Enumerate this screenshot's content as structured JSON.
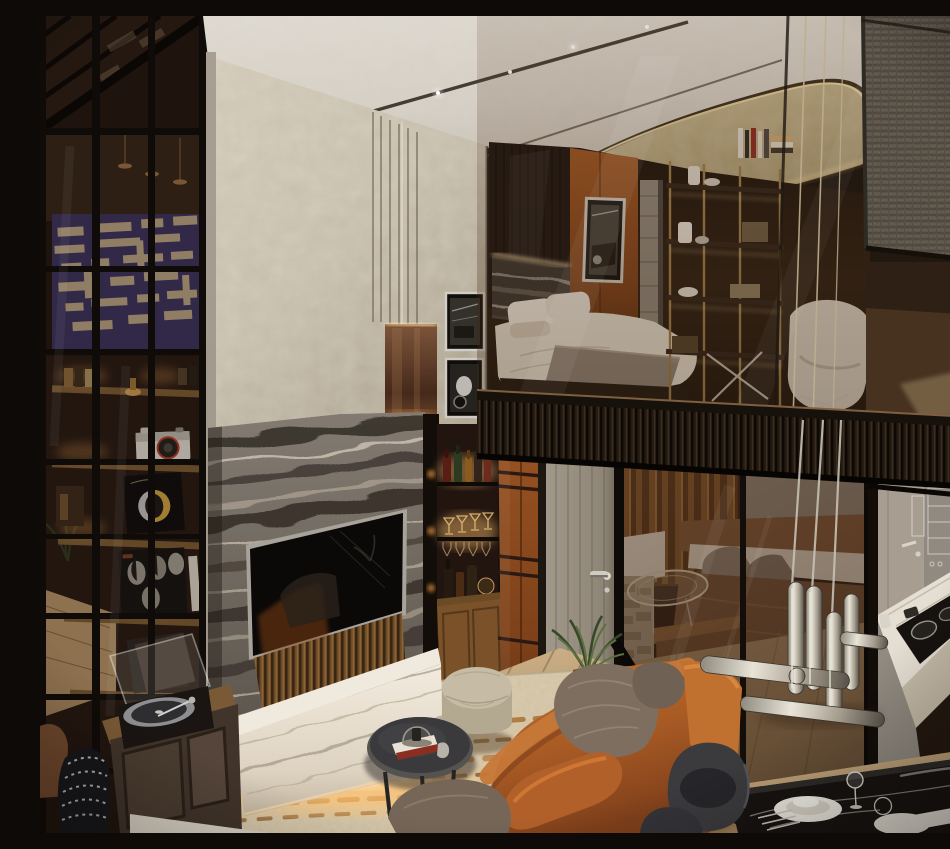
{
  "image": {
    "type": "photorealistic-interior-render",
    "alt": "Photorealistic render of a modern luxury loft: double-height living room with a gray veined-marble fireplace wall and recessed TV, white marble media console with warm under-lighting, cognac leather sofa with taupe cushions, round dark coffee table, beige fabric pouf, cream rug with rust streaks, black-framed glass partition with shelves holding a vintage camera and Daft Punk and Beatles vinyl sleeves, a turntable cabinet, a lit bar niche with bottles and stemware, a gray washed-wood door, a mezzanine bedroom behind bronze-tinted glass with brass shelving and a gold ceiling inset, a lower bedroom and small marble kitchen behind glass, sculptural chrome door pulls, and a black marble dining table with dark chairs.",
    "style_tags": [
      "modern luxury",
      "loft",
      "mezzanine",
      "bronze glass",
      "marble",
      "warm accent lighting"
    ]
  },
  "scene": {
    "areas": [
      {
        "id": "left-partition",
        "label": "black steel glass partition with abstract navy artwork and lit shelves"
      },
      {
        "id": "ceiling",
        "label": "white ceiling with recessed light tracks and gold coffered inset"
      },
      {
        "id": "plaster-wall",
        "label": "beige textured plaster wall with stepped column, bronze mirror inset and framed photos"
      },
      {
        "id": "fireplace-wall",
        "label": "gray wavy marble wall with recessed TV and fluted wood base"
      },
      {
        "id": "bar-niche",
        "label": "back-lit bar shelves with bottles and stemware above wood cabinet"
      },
      {
        "id": "mezzanine-bedroom",
        "label": "mezzanine bedroom behind bronze glass balustrade with bed, brass shelving and armchair"
      },
      {
        "id": "lower-bedroom",
        "label": "lower bedroom seen through tinted glass wall"
      },
      {
        "id": "kitchen",
        "label": "compact kitchen with white marble counter and black cooktop"
      },
      {
        "id": "living-area",
        "label": "living area with leather sofa, pouf, coffee table and rug"
      },
      {
        "id": "dining-area",
        "label": "black marble dining table with dark shell chairs"
      }
    ],
    "objects": [
      {
        "id": "abstract-art",
        "label": "navy abstract artwork with beige paper shapes"
      },
      {
        "id": "vintage-camera",
        "label": "white vintage camera with red lens ring"
      },
      {
        "id": "daft-punk-sleeve",
        "label": "Daft Punk helmet vinyl sleeve"
      },
      {
        "id": "beatles-sleeve",
        "label": "Beatles four-faces vinyl sleeve"
      },
      {
        "id": "turntable",
        "label": "record player with open acrylic lid"
      },
      {
        "id": "tv",
        "label": "recessed flat TV reflecting the sofa"
      },
      {
        "id": "white-console",
        "label": "white marble media console with LED under-glow"
      },
      {
        "id": "leather-sofa",
        "label": "cognac leather sofa"
      },
      {
        "id": "taupe-pillows",
        "label": "taupe fabric pillows"
      },
      {
        "id": "pouf",
        "label": "round beige fabric pouf"
      },
      {
        "id": "coffee-table",
        "label": "round dark metal coffee table with books and cloche"
      },
      {
        "id": "rug",
        "label": "cream rug with rust streaks"
      },
      {
        "id": "bar-bottles",
        "label": "liquor bottles and coupe glasses"
      },
      {
        "id": "door",
        "label": "gray washed-wood door with chrome lever"
      },
      {
        "id": "plant",
        "label": "potted palm sprigs"
      },
      {
        "id": "mezz-bed",
        "label": "mezzanine bed with white pillows and gray throw"
      },
      {
        "id": "brass-shelving",
        "label": "brass open shelving with books and decor"
      },
      {
        "id": "white-armchair",
        "label": "white lounge chair behind glass"
      },
      {
        "id": "gold-inset",
        "label": "gold textured ceiling coffer with rim light"
      },
      {
        "id": "woven-panel",
        "label": "gray woven wall panel"
      },
      {
        "id": "chrome-pulls",
        "label": "sculptural brushed-chrome glass door pulls"
      },
      {
        "id": "dining-table",
        "label": "black marble dining table with plates, glasses and cutlery"
      },
      {
        "id": "dining-chairs",
        "label": "charcoal shell dining chairs"
      },
      {
        "id": "knit-pouf",
        "label": "black and white knit pouf"
      },
      {
        "id": "kitchen-counter",
        "label": "white marble counter with black cooktop"
      }
    ],
    "palette": {
      "ceiling_white": "#d8d3c9",
      "plaster_beige": "#c8bfae",
      "bronze_glass": "#6b4a30",
      "black_frame": "#15100b",
      "marble_gray": "#736c63",
      "marble_vein_dark": "#39322b",
      "marble_white": "#e9e3d7",
      "wood_rust": "#94511f",
      "floor_oak": "#c2a379",
      "leather_cognac": "#b4642c",
      "pillow_taupe": "#7d6e60",
      "rug_cream": "#dbcfb6",
      "rug_rust": "#a3682a",
      "brass": "#a07c46",
      "chrome": "#cfcabf",
      "navy_art": "#3e3563",
      "art_beige": "#c3ac8a",
      "woven_gray": "#6e675e",
      "slat_dark": "#241a12",
      "glow_warm": "#f2b96e"
    }
  }
}
